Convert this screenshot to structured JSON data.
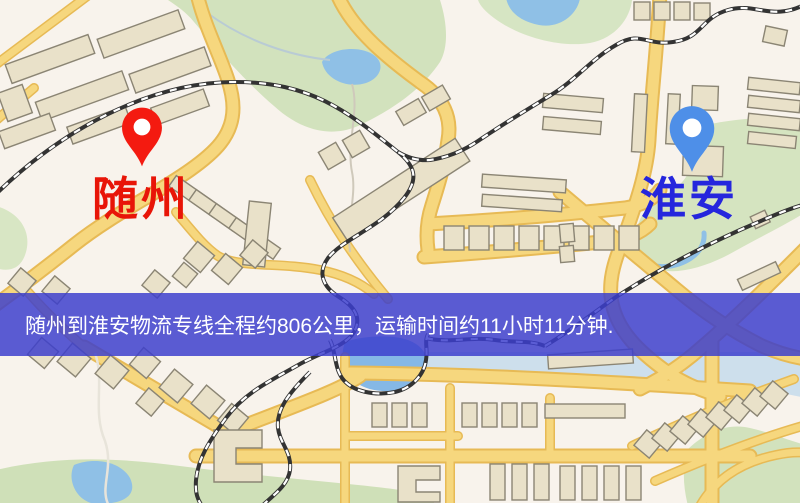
{
  "banner": {
    "text": "随州到淮安物流专线全程约806公里，运输时间约11小时11分钟.",
    "overlay_rgba": "rgba(60,62,205,0.84)",
    "text_color": "#ffffff"
  },
  "markers": {
    "origin": {
      "label": "随州",
      "label_color": "#e81508",
      "pin_color": "#f41a10",
      "pin_stroke": "#d11208"
    },
    "destination": {
      "label": "淮安",
      "label_color": "#2526dd",
      "pin_color": "#4e8fe8",
      "pin_stroke": "#3d7cdb"
    }
  },
  "route": {
    "origin": "随州",
    "destination": "淮安",
    "distance_text": "约806公里",
    "duration_text": "约11小时11分钟"
  },
  "map": {
    "colors": {
      "background": "#f8f3ec",
      "road_fill": "#f6d77e",
      "road_border": "#e7ba55",
      "building_fill": "#e9e1c9",
      "building_stroke": "#8b8574",
      "park_green": "#d2e2bd",
      "water_blue": "#8fc0e6",
      "railway_dark": "#333333"
    }
  }
}
